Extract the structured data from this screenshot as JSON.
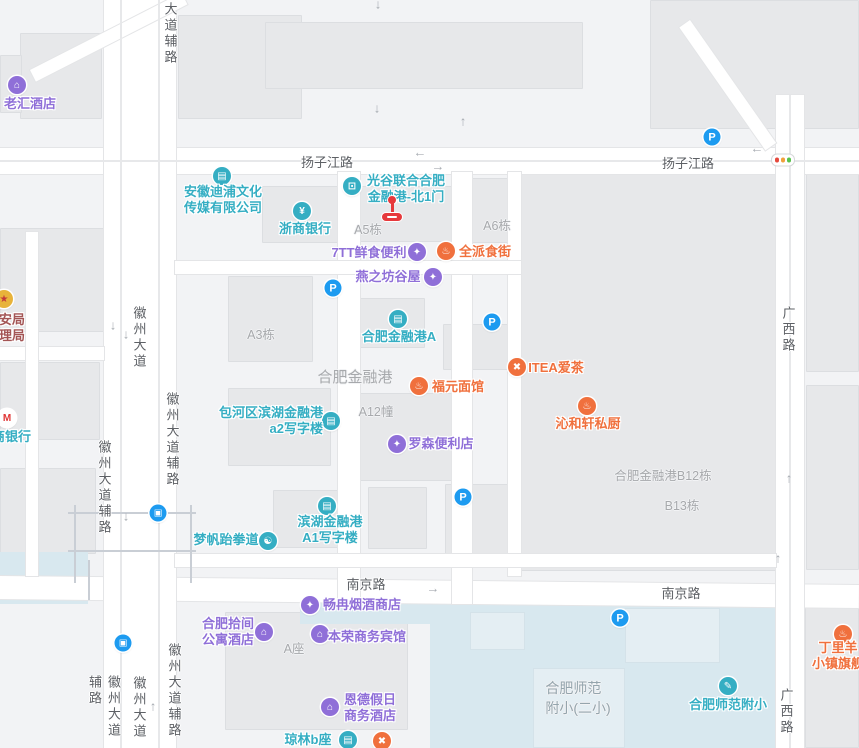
{
  "map": {
    "colors": {
      "background": "#f2f3f5",
      "building": "#e7e8ea",
      "water": "#d8e8ef",
      "road": "#ffffff",
      "teal": "#35aec3",
      "purple": "#8f6fd8",
      "orange": "#f0703d",
      "blue": "#1d9bf0",
      "gov": "#a35555",
      "red_marker": "#e6393c",
      "gray_label": "#a7a9ac",
      "road_label": "#5d6065",
      "school_label": "#95a5ad"
    },
    "blocks": [
      {
        "x": 20,
        "y": 33,
        "w": 82,
        "h": 86
      },
      {
        "x": 178,
        "y": 15,
        "w": 124,
        "h": 104
      },
      {
        "x": 265,
        "y": 22,
        "w": 318,
        "h": 67
      },
      {
        "x": 650,
        "y": 0,
        "w": 209,
        "h": 129
      },
      {
        "x": 0,
        "y": 55,
        "w": 22,
        "h": 58
      },
      {
        "x": 0,
        "y": 228,
        "w": 104,
        "h": 104
      },
      {
        "x": 0,
        "y": 362,
        "w": 100,
        "h": 78
      },
      {
        "x": 0,
        "y": 468,
        "w": 96,
        "h": 86
      },
      {
        "x": 262,
        "y": 186,
        "w": 76,
        "h": 57
      },
      {
        "x": 340,
        "y": 186,
        "w": 116,
        "h": 56
      },
      {
        "x": 462,
        "y": 178,
        "w": 177,
        "h": 65
      },
      {
        "x": 228,
        "y": 276,
        "w": 85,
        "h": 86
      },
      {
        "x": 352,
        "y": 298,
        "w": 73,
        "h": 50
      },
      {
        "x": 443,
        "y": 324,
        "w": 78,
        "h": 46
      },
      {
        "x": 228,
        "y": 388,
        "w": 103,
        "h": 78
      },
      {
        "x": 350,
        "y": 393,
        "w": 107,
        "h": 88
      },
      {
        "x": 273,
        "y": 490,
        "w": 85,
        "h": 58
      },
      {
        "x": 368,
        "y": 487,
        "w": 59,
        "h": 62
      },
      {
        "x": 445,
        "y": 484,
        "w": 93,
        "h": 77
      },
      {
        "x": 520,
        "y": 172,
        "w": 256,
        "h": 399
      },
      {
        "x": 225,
        "y": 612,
        "w": 183,
        "h": 118
      },
      {
        "x": 805,
        "y": 600,
        "w": 54,
        "h": 148
      },
      {
        "x": 806,
        "y": 172,
        "w": 53,
        "h": 200
      },
      {
        "x": 806,
        "y": 385,
        "w": 53,
        "h": 185
      }
    ],
    "water_areas": [
      {
        "x": 300,
        "y": 598,
        "w": 132,
        "h": 26
      },
      {
        "x": 430,
        "y": 598,
        "w": 346,
        "h": 150
      },
      {
        "x": 0,
        "y": 552,
        "w": 88,
        "h": 52
      }
    ],
    "water_blocks": [
      {
        "x": 533,
        "y": 668,
        "w": 92,
        "h": 80
      },
      {
        "x": 625,
        "y": 608,
        "w": 95,
        "h": 55
      },
      {
        "x": 470,
        "y": 612,
        "w": 55,
        "h": 38
      }
    ],
    "roads": [
      {
        "x": 0,
        "y": 148,
        "w": 859,
        "h": 26,
        "rot": 0
      },
      {
        "x": 0,
        "y": 576,
        "w": 859,
        "h": 23,
        "rot": 0.6
      },
      {
        "x": 104,
        "y": 0,
        "w": 72,
        "h": 748,
        "rot": 0
      },
      {
        "x": 776,
        "y": 95,
        "w": 28,
        "h": 653,
        "rot": 0
      },
      {
        "x": 338,
        "y": 172,
        "w": 22,
        "h": 432,
        "rot": 0
      },
      {
        "x": 452,
        "y": 172,
        "w": 20,
        "h": 432,
        "rot": 0
      },
      {
        "x": 508,
        "y": 172,
        "w": 13,
        "h": 404,
        "rot": 0
      },
      {
        "x": 175,
        "y": 261,
        "w": 346,
        "h": 13,
        "rot": 0
      },
      {
        "x": 175,
        "y": 554,
        "w": 601,
        "h": 13,
        "rot": 0
      },
      {
        "x": 0,
        "y": 347,
        "w": 104,
        "h": 13,
        "rot": 0
      },
      {
        "x": 26,
        "y": 232,
        "w": 12,
        "h": 344,
        "rot": 0
      },
      {
        "x": 30,
        "y": 70,
        "w": 170,
        "h": 13,
        "rot": -27
      },
      {
        "x": 690,
        "y": 20,
        "w": 150,
        "h": 13,
        "rot": 55
      }
    ],
    "lane_lines": [
      {
        "x": 120,
        "y": 0,
        "w": 2,
        "h": 748
      },
      {
        "x": 158,
        "y": 0,
        "w": 2,
        "h": 748
      },
      {
        "x": 789,
        "y": 95,
        "w": 2,
        "h": 653
      },
      {
        "x": 0,
        "y": 160,
        "w": 859,
        "h": 2
      }
    ],
    "overpass_lines": [
      {
        "x": 68,
        "y": 512,
        "w": 128,
        "h": 2
      },
      {
        "x": 68,
        "y": 550,
        "w": 128,
        "h": 2
      },
      {
        "x": 74,
        "y": 505,
        "w": 2,
        "h": 78
      },
      {
        "x": 190,
        "y": 505,
        "w": 2,
        "h": 78
      },
      {
        "x": 88,
        "y": 560,
        "w": 2,
        "h": 40
      }
    ],
    "road_labels_h": [
      {
        "id": "yangzijiang-road-w",
        "text": "扬子江路",
        "x": 327,
        "y": 152
      },
      {
        "id": "yangzijiang-road-e",
        "text": "扬子江路",
        "x": 688,
        "y": 153
      },
      {
        "id": "nanjing-road-w",
        "text": "南京路",
        "x": 366,
        "y": 574
      },
      {
        "id": "nanjing-road-e",
        "text": "南京路",
        "x": 681,
        "y": 583
      }
    ],
    "road_labels_v": [
      {
        "id": "dadaofulu-top",
        "text": "大道辅路",
        "x": 170,
        "y": 2
      },
      {
        "id": "huizhou-avenue-mid",
        "text": "徽州大道",
        "x": 139,
        "y": 306
      },
      {
        "id": "huizhou-fulu-east",
        "text": "徽州大道辅路",
        "x": 172,
        "y": 392
      },
      {
        "id": "huizhou-fulu-west",
        "text": "徽州大道辅路",
        "x": 104,
        "y": 440
      },
      {
        "id": "huizhou-fulu-east2",
        "text": "徽州大道辅路",
        "x": 174,
        "y": 643
      },
      {
        "id": "huizhou-avenue-bottom",
        "text": "徽州大道",
        "x": 139,
        "y": 676
      },
      {
        "id": "huizhou-fulu-west2",
        "text": "徽州大道辅路",
        "x": 104,
        "y": 675
      },
      {
        "id": "guangxi-road-top",
        "text": "广西路",
        "x": 788,
        "y": 306
      },
      {
        "id": "guangxi-road-bottom",
        "text": "广西路",
        "x": 786,
        "y": 688
      }
    ],
    "area_labels": [
      {
        "id": "a5-building",
        "lines": [
          "A5栋"
        ],
        "x": 368,
        "y": 219,
        "size": 12.5
      },
      {
        "id": "a6-building",
        "lines": [
          "A6栋"
        ],
        "x": 497,
        "y": 215,
        "size": 12.5
      },
      {
        "id": "a3-building",
        "lines": [
          "A3栋"
        ],
        "x": 261,
        "y": 324,
        "size": 12.5
      },
      {
        "id": "hefei-financial-port",
        "lines": [
          "合肥金融港"
        ],
        "x": 355,
        "y": 366,
        "size": 15
      },
      {
        "id": "a12-building",
        "lines": [
          "A12幢"
        ],
        "x": 376,
        "y": 401,
        "size": 12.5
      },
      {
        "id": "b12-building",
        "lines": [
          "合肥金融港B12栋"
        ],
        "x": 663,
        "y": 465,
        "size": 12.5
      },
      {
        "id": "b13-building",
        "lines": [
          "B13栋"
        ],
        "x": 682,
        "y": 495,
        "size": 12.5
      },
      {
        "id": "a-block",
        "lines": [
          "A座"
        ],
        "x": 294,
        "y": 638,
        "size": 12.5
      },
      {
        "id": "shifan-erxiao",
        "lines": [
          "合肥师范",
          "附小(二小)"
        ],
        "x": 578,
        "y": 678,
        "size": 14,
        "color": "#95a5ad"
      }
    ],
    "pois": [
      {
        "id": "laohui-hotel",
        "cat": "purple",
        "glyph": "hotel",
        "icon": {
          "x": 17,
          "y": 85
        },
        "label": {
          "x": 30,
          "y": 96,
          "align": "center",
          "lines": [
            "老汇酒店"
          ]
        }
      },
      {
        "id": "anhui-dipu-media",
        "cat": "teal",
        "glyph": "building",
        "icon": {
          "x": 222,
          "y": 176
        },
        "label": {
          "x": 223,
          "y": 184,
          "align": "center",
          "lines": [
            "安徽迪浦文化",
            "传媒有限公司"
          ]
        }
      },
      {
        "id": "zheshang-bank",
        "cat": "teal",
        "glyph": "bank",
        "icon": {
          "x": 302,
          "y": 211
        },
        "label": {
          "x": 305,
          "y": 221,
          "align": "center",
          "lines": [
            "浙商银行"
          ]
        }
      },
      {
        "id": "guanggu-north-gate1",
        "cat": "teal",
        "glyph": "entrance",
        "icon": {
          "x": 352,
          "y": 186
        },
        "label": {
          "x": 406,
          "y": 173,
          "align": "center",
          "lines": [
            "光谷联合合肥",
            "金融港-北1门"
          ]
        }
      },
      {
        "id": "7tt-convenience",
        "cat": "purple",
        "glyph": "shop",
        "icon": {
          "x": 417,
          "y": 252
        },
        "label": {
          "x": 369,
          "y": 245,
          "align": "center",
          "lines": [
            "7TT鲜食便利"
          ]
        }
      },
      {
        "id": "quanpai-food-street",
        "cat": "orange",
        "glyph": "bowl",
        "icon": {
          "x": 446,
          "y": 251
        },
        "label": {
          "x": 485,
          "y": 244,
          "align": "center",
          "lines": [
            "全派食街"
          ]
        }
      },
      {
        "id": "yanzhifang-guwu",
        "cat": "purple",
        "glyph": "shop",
        "icon": {
          "x": 433,
          "y": 277
        },
        "label": {
          "x": 388,
          "y": 269,
          "align": "center",
          "lines": [
            "燕之坊谷屋"
          ]
        }
      },
      {
        "id": "hefei-financial-port-a",
        "cat": "teal",
        "glyph": "building",
        "icon": {
          "x": 398,
          "y": 319
        },
        "label": {
          "x": 399,
          "y": 329,
          "align": "center",
          "lines": [
            "合肥金融港A"
          ]
        }
      },
      {
        "id": "fuyuan-noodle",
        "cat": "orange",
        "glyph": "bowl",
        "icon": {
          "x": 419,
          "y": 386
        },
        "label": {
          "x": 458,
          "y": 379,
          "align": "center",
          "lines": [
            "福元面馆"
          ]
        }
      },
      {
        "id": "itea-tea",
        "cat": "orange",
        "glyph": "utensils",
        "icon": {
          "x": 517,
          "y": 367
        },
        "label": {
          "x": 556,
          "y": 360,
          "align": "center",
          "lines": [
            "ITEA爱茶"
          ]
        }
      },
      {
        "id": "qinhexuan-kitchen",
        "cat": "orange",
        "glyph": "bowl",
        "icon": {
          "x": 587,
          "y": 406
        },
        "label": {
          "x": 588,
          "y": 416,
          "align": "center",
          "lines": [
            "沁和轩私厨"
          ]
        }
      },
      {
        "id": "baohe-binhu-a2-office",
        "cat": "teal",
        "glyph": "building",
        "icon": {
          "x": 331,
          "y": 421
        },
        "label": {
          "x": 323,
          "y": 405,
          "align": "right",
          "lines": [
            "包河区滨湖金融港",
            "a2写字楼"
          ]
        }
      },
      {
        "id": "lawson-convenience",
        "cat": "purple",
        "glyph": "shop",
        "icon": {
          "x": 397,
          "y": 444
        },
        "label": {
          "x": 441,
          "y": 436,
          "align": "center",
          "lines": [
            "罗森便利店"
          ]
        }
      },
      {
        "id": "binhu-a1-office",
        "cat": "teal",
        "glyph": "building",
        "icon": {
          "x": 327,
          "y": 506
        },
        "label": {
          "x": 330,
          "y": 514,
          "align": "center",
          "lines": [
            "滨湖金融港",
            "A1写字楼"
          ]
        }
      },
      {
        "id": "mengfan-taekwondo",
        "cat": "teal",
        "glyph": "sport",
        "icon": {
          "x": 268,
          "y": 541
        },
        "label": {
          "x": 226,
          "y": 532,
          "align": "center",
          "lines": [
            "梦帆跆拳道"
          ]
        }
      },
      {
        "id": "changran-tobacco",
        "cat": "purple",
        "glyph": "shop",
        "icon": {
          "x": 310,
          "y": 605
        },
        "label": {
          "x": 362,
          "y": 597,
          "align": "center",
          "lines": [
            "畅冉烟酒商店"
          ]
        }
      },
      {
        "id": "hefei-shijian-apartment",
        "cat": "purple",
        "glyph": "hotel",
        "icon": {
          "x": 264,
          "y": 632
        },
        "label": {
          "x": 228,
          "y": 616,
          "align": "center",
          "lines": [
            "合肥拾间",
            "公寓酒店"
          ]
        }
      },
      {
        "id": "benrong-hotel",
        "cat": "purple",
        "glyph": "hotel",
        "icon": {
          "x": 320,
          "y": 634
        },
        "label": {
          "x": 367,
          "y": 629,
          "align": "center",
          "lines": [
            "本荣商务宾馆"
          ]
        }
      },
      {
        "id": "ende-holiday-hotel",
        "cat": "purple",
        "glyph": "hotel",
        "icon": {
          "x": 330,
          "y": 707
        },
        "label": {
          "x": 370,
          "y": 692,
          "align": "center",
          "lines": [
            "恩德假日",
            "商务酒店"
          ]
        }
      },
      {
        "id": "qionglin-b-block",
        "cat": "teal",
        "glyph": "building",
        "icon": {
          "x": 348,
          "y": 740
        },
        "label": {
          "x": 308,
          "y": 732,
          "align": "center",
          "lines": [
            "琼林b座"
          ]
        }
      },
      {
        "id": "bottom-restaurant",
        "cat": "orange",
        "glyph": "utensils",
        "icon": {
          "x": 382,
          "y": 741
        },
        "label": null
      },
      {
        "id": "shifan-fuxiao",
        "cat": "teal",
        "glyph": "school",
        "icon": {
          "x": 728,
          "y": 686
        },
        "label": {
          "x": 728,
          "y": 697,
          "align": "center",
          "lines": [
            "合肥师范附小"
          ]
        }
      },
      {
        "id": "dingliyang-flagship",
        "cat": "orange",
        "glyph": "bowl",
        "icon": {
          "x": 843,
          "y": 634
        },
        "label": {
          "x": 838,
          "y": 640,
          "align": "center",
          "lines": [
            "丁里羊",
            "小镇旗舰"
          ]
        }
      },
      {
        "id": "public-security-bureau",
        "cat": "gov",
        "glyph": "badge",
        "iconBg": "#e8b33a",
        "iconFg": "#c23a3a",
        "icon": {
          "x": 4,
          "y": 299
        },
        "label": {
          "x": -14,
          "y": 312,
          "align": "left",
          "lines": [
            "公安局",
            "管理局"
          ]
        }
      },
      {
        "id": "merchants-bank",
        "cat": "teal",
        "glyph": "cmb",
        "iconBg": "#ffffff",
        "iconFg": "#e03535",
        "icon": {
          "x": 7,
          "y": 418
        },
        "label": {
          "x": -8,
          "y": 429,
          "align": "left",
          "lines": [
            "商银行"
          ]
        }
      }
    ],
    "parking_icons": [
      {
        "x": 712,
        "y": 137
      },
      {
        "x": 333,
        "y": 288
      },
      {
        "x": 492,
        "y": 322
      },
      {
        "x": 463,
        "y": 497
      },
      {
        "x": 620,
        "y": 618
      }
    ],
    "transit_icons": [
      {
        "x": 158,
        "y": 513
      },
      {
        "x": 123,
        "y": 643
      }
    ],
    "traffic_light": {
      "x": 783,
      "y": 160,
      "dots": [
        "#e5493d",
        "#f0a13c",
        "#58c24c"
      ]
    },
    "gate_marker": {
      "x": 392,
      "y": 196
    },
    "arrows": [
      {
        "x": 378,
        "y": 4,
        "g": "↓"
      },
      {
        "x": 377,
        "y": 108,
        "g": "↓"
      },
      {
        "x": 463,
        "y": 121,
        "g": "↑"
      },
      {
        "x": 757,
        "y": 148,
        "g": "←"
      },
      {
        "x": 420,
        "y": 152,
        "g": "←"
      },
      {
        "x": 438,
        "y": 166,
        "g": "→"
      },
      {
        "x": 113,
        "y": 325,
        "g": "↓"
      },
      {
        "x": 126,
        "y": 334,
        "g": "↓"
      },
      {
        "x": 126,
        "y": 516,
        "g": "↓"
      },
      {
        "x": 433,
        "y": 588,
        "g": "→"
      },
      {
        "x": 789,
        "y": 478,
        "g": "↑"
      },
      {
        "x": 778,
        "y": 558,
        "g": "↑"
      },
      {
        "x": 153,
        "y": 706,
        "g": "↑"
      }
    ],
    "glyphs": {
      "hotel": "⌂",
      "shop": "✦",
      "bank": "¥",
      "building": "▤",
      "entrance": "⊡",
      "bowl": "♨",
      "utensils": "✖",
      "school": "✎",
      "sport": "☯",
      "badge": "★",
      "cmb": "M",
      "parking": "P",
      "bus": "▣"
    }
  }
}
